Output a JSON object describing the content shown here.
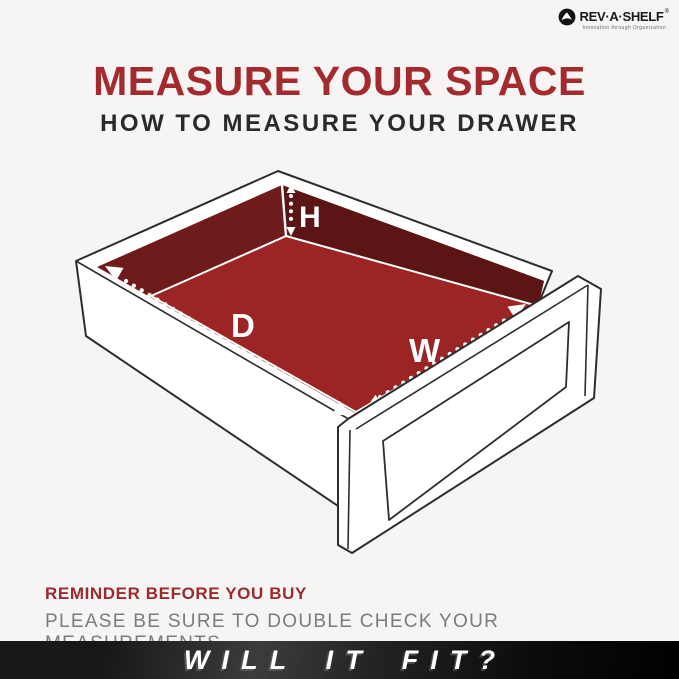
{
  "colors": {
    "background": "#f6f5f3",
    "accent_red": "#a32a2e",
    "wall_dark_red": "#6e1b1b",
    "wall_darker_red": "#5c1515",
    "floor_red": "#9b2525",
    "outline_dark": "#2d2d2d",
    "measure_white": "#ffffff",
    "body_gray": "#7b7b7b",
    "banner_black": "#111111"
  },
  "logo": {
    "brand": "REV·A·SHELF",
    "registered": "®",
    "tagline": "Innovation through Organization"
  },
  "header": {
    "title": "MEASURE YOUR SPACE",
    "subtitle": "HOW TO MEASURE YOUR DRAWER"
  },
  "diagram": {
    "height_label": "H",
    "depth_label": "D",
    "width_label": "W"
  },
  "reminder": {
    "heading": "REMINDER BEFORE YOU BUY",
    "body": "PLEASE BE SURE TO DOUBLE CHECK YOUR MEASUREMENTS."
  },
  "banner": {
    "text": "WILL IT FIT?"
  }
}
